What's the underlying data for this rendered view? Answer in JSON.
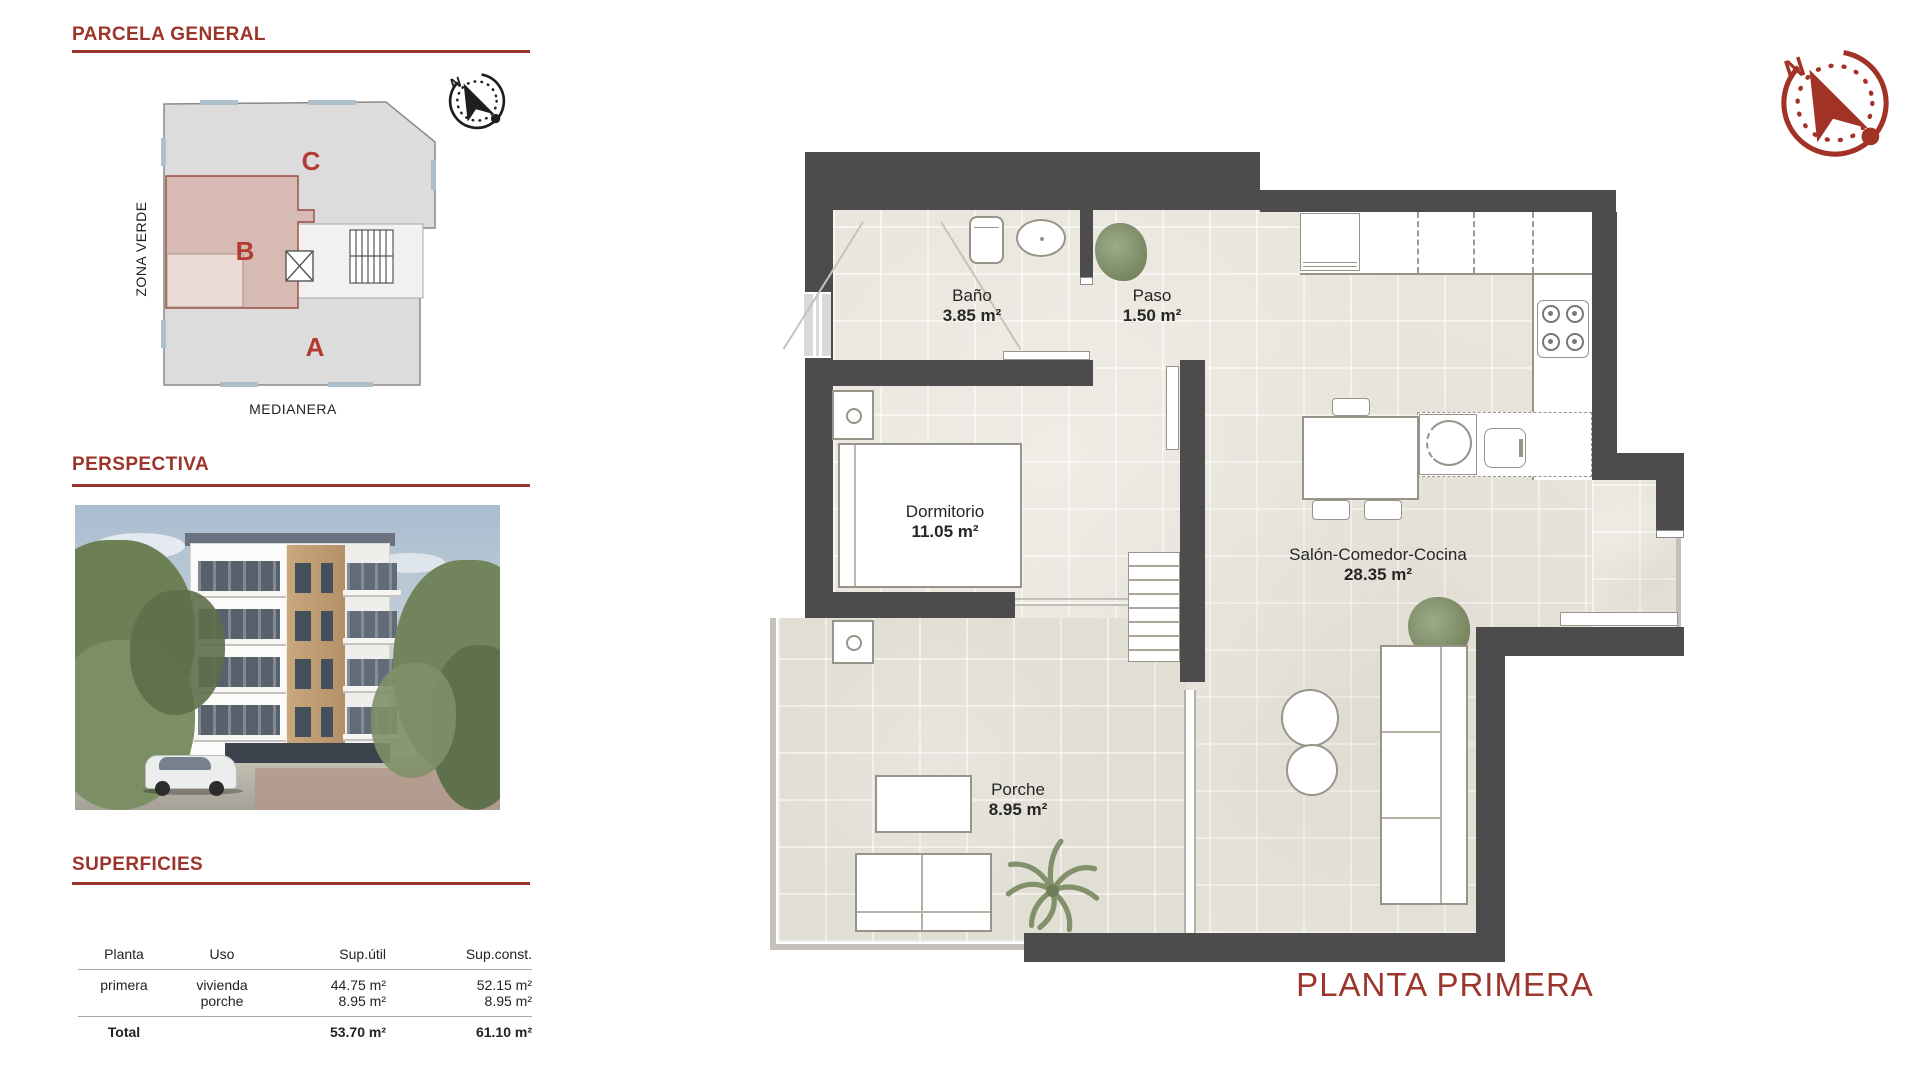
{
  "colors": {
    "maroon": "#9b342b",
    "zone_letter": "#b23a30",
    "wall": "#4c4c4c",
    "floor": "#e9e5dc",
    "porche_floor": "#e1ded4",
    "zone_b_fill": "#d7bab4",
    "site_gray": "#dcdcdc",
    "title_red": "#9c352c",
    "compass_red": "#a33226"
  },
  "parcela": {
    "heading": "PARCELA GENERAL",
    "zone_a": "A",
    "zone_b": "B",
    "zone_c": "C",
    "zona_verde": "ZONA VERDE",
    "medianera": "MEDIANERA"
  },
  "perspectiva": {
    "heading": "PERSPECTIVA"
  },
  "superficies": {
    "heading": "SUPERFICIES",
    "col_planta": "Planta",
    "col_uso": "Uso",
    "col_sup_util": "Sup.útil",
    "col_sup_const": "Sup.const.",
    "row_planta": "primera",
    "row_uso_1": "vivienda",
    "row_uso_2": "porche",
    "row_util_1": "44.75 m²",
    "row_util_2": "8.95 m²",
    "row_const_1": "52.15 m²",
    "row_const_2": "8.95 m²",
    "total_label": "Total",
    "total_util": "53.70 m²",
    "total_const": "61.10 m²"
  },
  "plan": {
    "title": "PLANTA PRIMERA",
    "rooms": [
      {
        "name": "Baño",
        "area": "3.85 m²"
      },
      {
        "name": "Paso",
        "area": "1.50 m²"
      },
      {
        "name": "Dormitorio",
        "area": "11.05 m²"
      },
      {
        "name": "Salón-Comedor-Cocina",
        "area": "28.35 m²"
      },
      {
        "name": "Porche",
        "area": "8.95 m²"
      }
    ]
  },
  "compass": {
    "north": "N"
  }
}
